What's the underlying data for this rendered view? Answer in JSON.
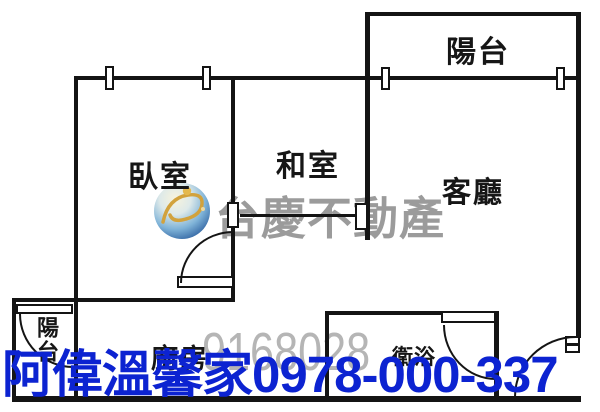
{
  "image_type": "real-estate floor plan",
  "rooms": {
    "balcony_top": "陽台",
    "bedroom": "臥室",
    "tatami": "和室",
    "living": "客廳",
    "kitchen": "廚房",
    "bathroom": "衛浴",
    "balcony_bottom": "陽台"
  },
  "watermark": {
    "brand": "台慶不動產",
    "code": "9168028",
    "brand_color": "#9b9b9b",
    "code_color": "#b5b5b5",
    "logo": "globe-swoosh-logo"
  },
  "overlay": {
    "agent_name": "阿偉溫馨家",
    "phone": "0978-000-337",
    "color": "#0c23d1"
  },
  "colors": {
    "wall": "#141414",
    "background": "#ffffff"
  }
}
